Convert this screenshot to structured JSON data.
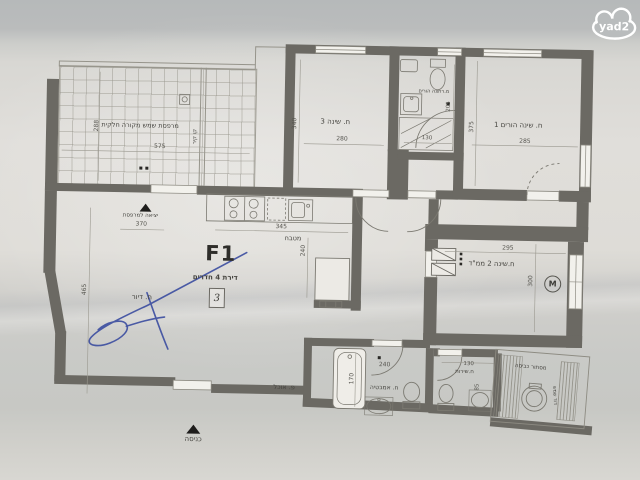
{
  "watermark": {
    "text": "yad2"
  },
  "plan": {
    "id": "F1",
    "type_label": "דירת 4 חדרים",
    "unit_number": "3",
    "mamad_window_symbol": "M"
  },
  "rooms": {
    "terrace": {
      "name": "מרפסת שמש מקורה חלקית",
      "w": "575",
      "h": "288"
    },
    "wall_line": {
      "note": "קו קיר"
    },
    "bedroom3": {
      "name": "ח. שינה 3",
      "w": "280",
      "h": "340"
    },
    "parents_bath": {
      "name": "מ.רחצה הורים",
      "w": "130",
      "h": "205"
    },
    "bedroom1": {
      "name": "ח. שינה הורים 1",
      "w": "285",
      "h": "375"
    },
    "bedroom2": {
      "name": "ח.שינה 2 ממ\"ד",
      "w": "295",
      "h": "300"
    },
    "kitchen": {
      "name": "מטבח",
      "w": "345",
      "h": "240"
    },
    "living": {
      "name": "ח. דיור",
      "h": "465"
    },
    "dining": {
      "name": "פ. אוכל"
    },
    "bathroom": {
      "name": "ח. אמבטיה",
      "door_w": "240",
      "tub_h": "170"
    },
    "service_wc": {
      "name": "ח.שירות",
      "w": "130",
      "h": "85"
    },
    "laundry": {
      "name": "מסתור כביסה",
      "heater": "דוד שמש"
    }
  },
  "markers": {
    "terrace_exit": {
      "label": "יציאה למרפסת",
      "w": "370"
    },
    "entrance": {
      "label": "כניסה"
    }
  },
  "colors": {
    "background": "#b9bcbd",
    "paper": "#e0deda",
    "wall": "#6b6963",
    "ink": "#45443f",
    "signature_blue": "#3b4da0"
  }
}
